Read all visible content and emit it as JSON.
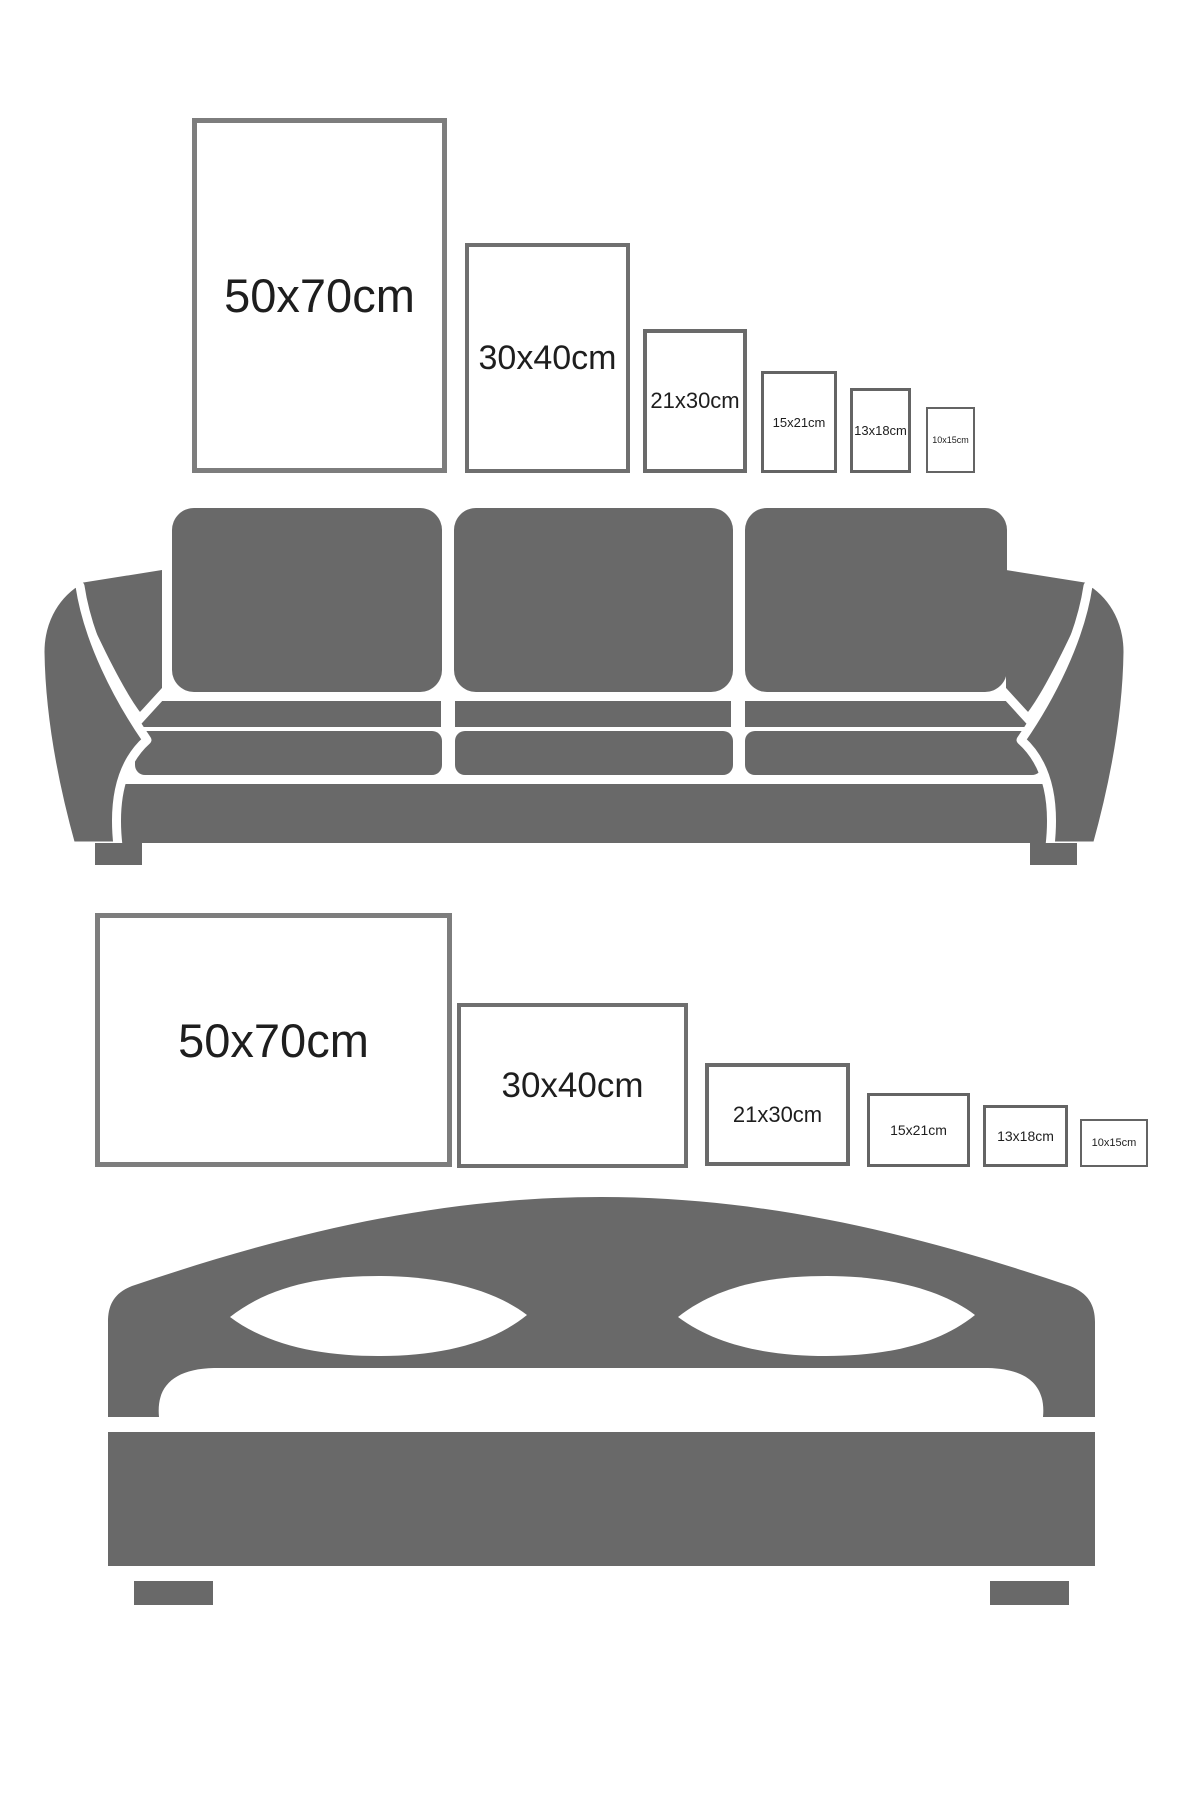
{
  "colors": {
    "background": "#ffffff",
    "furniture": "#696969",
    "frame_border_large": "#7d7d7d",
    "frame_border_small": "#646464",
    "label_text": "#1e1e1e"
  },
  "size_guide": {
    "rows": [
      {
        "furniture": "sofa",
        "frame_orientation": "portrait",
        "sizes": [
          "50x70cm",
          "30x40cm",
          "21x30cm",
          "15x21cm",
          "13x18cm",
          "10x15cm"
        ]
      },
      {
        "furniture": "bed",
        "frame_orientation": "landscape",
        "sizes": [
          "50x70cm",
          "30x40cm",
          "21x30cm",
          "15x21cm",
          "13x18cm",
          "10x15cm"
        ]
      }
    ]
  }
}
